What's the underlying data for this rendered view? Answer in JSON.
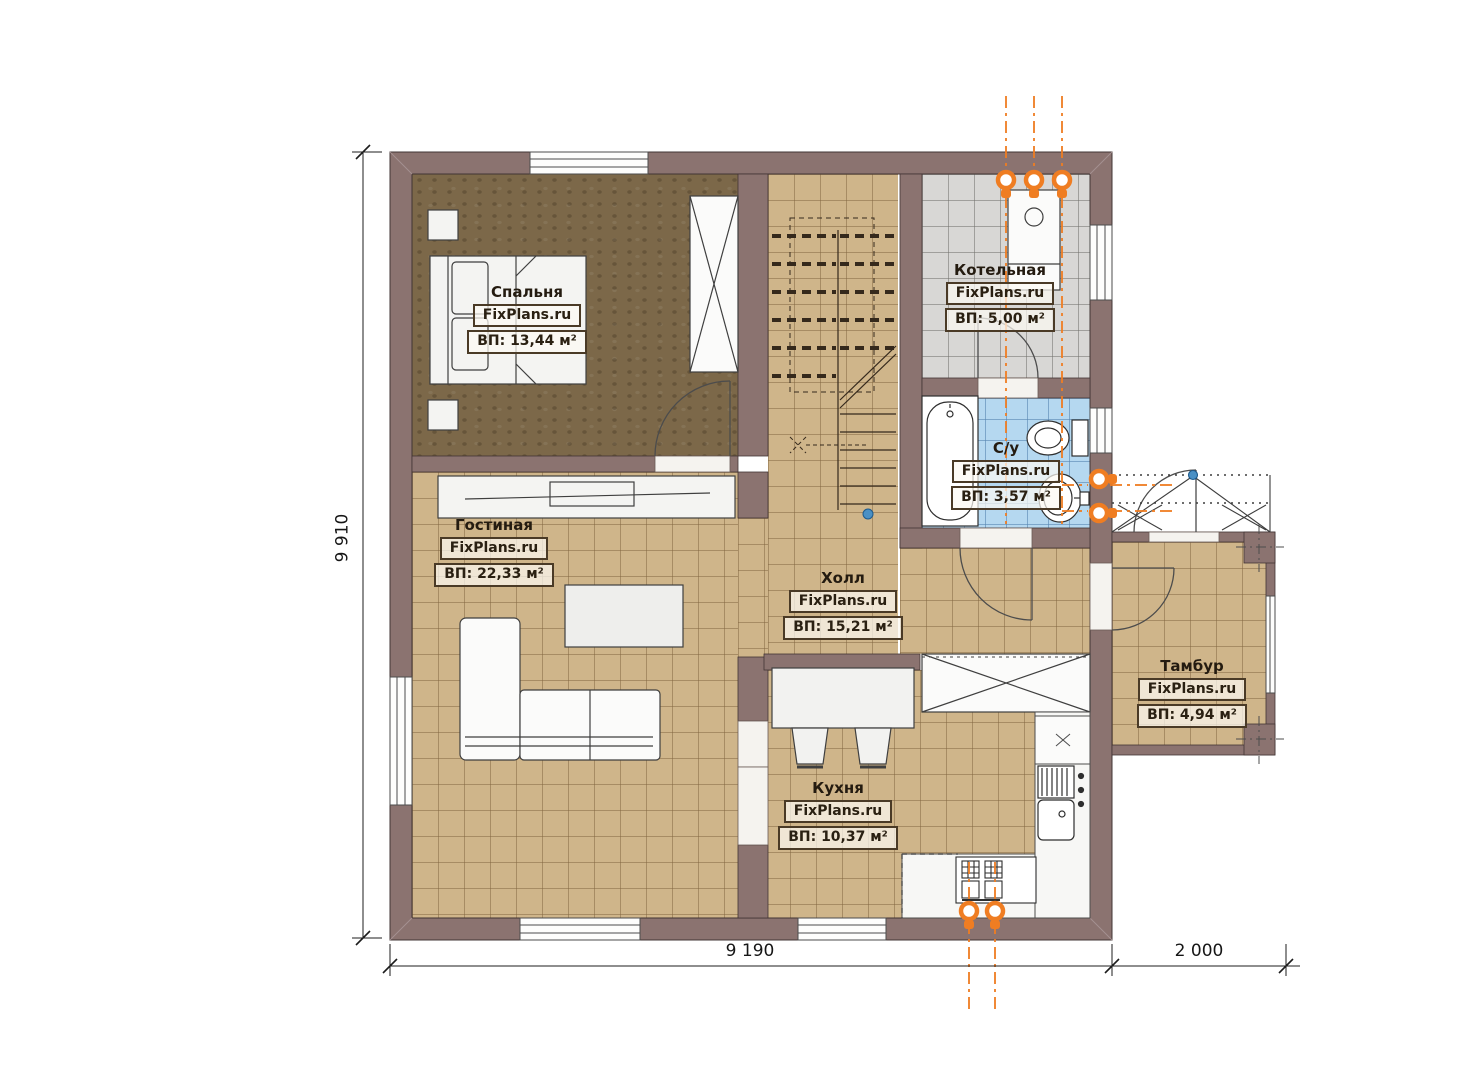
{
  "plan_type": "floor-plan",
  "brand": "FixPlans.ru",
  "rooms": [
    {
      "key": "bedroom",
      "name": "Спальня",
      "brand": "FixPlans.ru",
      "area": "ВП: 13,44 м²"
    },
    {
      "key": "boiler",
      "name": "Котельная",
      "brand": "FixPlans.ru",
      "area": "ВП: 5,00 м²"
    },
    {
      "key": "bathroom",
      "name": "С/у",
      "brand": "FixPlans.ru",
      "area": "ВП: 3,57 м²"
    },
    {
      "key": "living",
      "name": "Гостиная",
      "brand": "FixPlans.ru",
      "area": "ВП: 22,33 м²"
    },
    {
      "key": "hall",
      "name": "Холл",
      "brand": "FixPlans.ru",
      "area": "ВП: 15,21 м²"
    },
    {
      "key": "kitchen",
      "name": "Кухня",
      "brand": "FixPlans.ru",
      "area": "ВП: 10,37 м²"
    },
    {
      "key": "vestibule",
      "name": "Тамбур",
      "brand": "FixPlans.ru",
      "area": "ВП: 4,94 м²"
    }
  ],
  "dimensions": {
    "left": "9 910",
    "bottom_main": "9 190",
    "bottom_porch": "2 000"
  },
  "colors": {
    "wall": "#8b7370",
    "floor_tan": "#cfb58a",
    "floor_brown": "#7c6849",
    "tile_gray": "#d8d7d5",
    "tile_blue": "#b5d8f0",
    "utility_orange": "#ef7d22",
    "marker_blue": "#4a90c4"
  }
}
